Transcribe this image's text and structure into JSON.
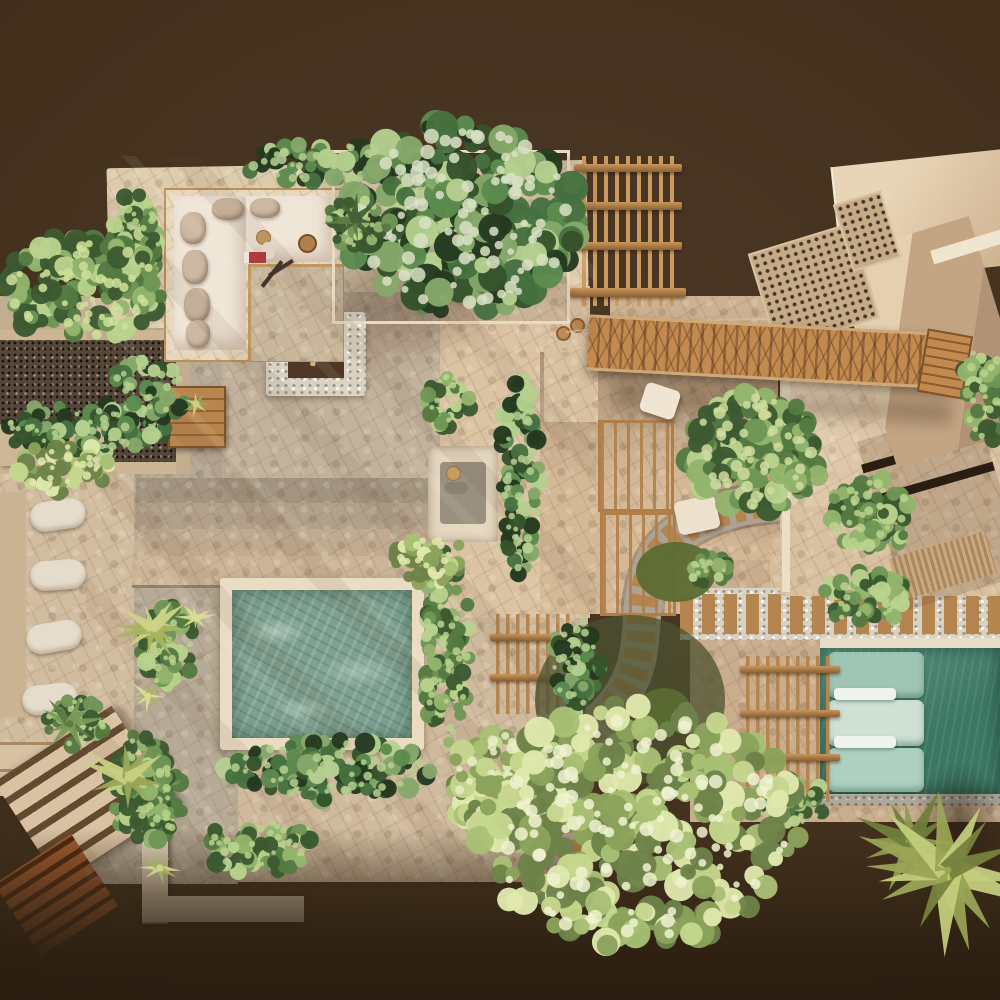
{
  "scene": {
    "description": "aerial-top-down-render-of-tropical-villa-rooftop-terraces",
    "visible_text": ""
  },
  "palette": {
    "background": "#43301d",
    "background_deep": "#2d2012",
    "terrace": "#d0ba9d",
    "terrace_light": "#ddcbae",
    "terrace_gray": "#b7aa96",
    "white_wall": "#e9dcc3",
    "sofa_cream": "#f0e6d8",
    "cushion_tan": "#cdb8a3",
    "wood": "#b5854f",
    "wood_dark": "#8a5f33",
    "wood_light": "#c9975c",
    "pool_main": "#7da090",
    "pool_main_highlight": "#cfe0d0",
    "pool_right": "#3c7763",
    "pool_right_light": "#5d9480",
    "daybed_mint": "#9fc5b4",
    "daybed_mint_light": "#cfe0d4",
    "gravel": "#55473a",
    "pebble": "#ddd6c8",
    "grass": "#5c6c33",
    "fire_logs": "#d9b07b",
    "person_hat": "#c79c63",
    "book_red": "#b23a3f"
  },
  "vegetation_palettes": {
    "greens_dark": [
      "#24391f",
      "#35522c",
      "#477041",
      "#5c8a4f",
      "#86a86a",
      "#b5cf8f"
    ],
    "greens_mid": [
      "#3c5a31",
      "#547a42",
      "#6f9655",
      "#93b46d",
      "#b9d28c"
    ],
    "greens_light": [
      "#6d8249",
      "#8ba25c",
      "#a9bf75",
      "#c6d68e",
      "#e0e8ad"
    ]
  },
  "grass": [
    {
      "name": "undergrowth",
      "cx": 630,
      "cy": 700,
      "rx": 95,
      "ry": 85,
      "color": "#4c5230",
      "opacity": 0.75
    },
    {
      "name": "grass-1",
      "cx": 676,
      "cy": 572,
      "rx": 40,
      "ry": 30,
      "color": "#5c6c33",
      "opacity": 0.95
    },
    {
      "name": "grass-2",
      "cx": 664,
      "cy": 708,
      "rx": 26,
      "ry": 20,
      "color": "#5c6c33",
      "opacity": 0.9
    }
  ],
  "foliage": [
    {
      "name": "planter-hedge-top",
      "cx": 332,
      "cy": 162,
      "rx": 92,
      "ry": 20,
      "n": 70,
      "rmin": 5,
      "rmax": 11,
      "pal": "greens_dark",
      "seed": 1
    },
    {
      "name": "big-tree-top",
      "cx": 462,
      "cy": 218,
      "rx": 118,
      "ry": 96,
      "n": 230,
      "rmin": 7,
      "rmax": 17,
      "pal": "greens_dark",
      "seed": 2,
      "hi": "#d9e0c4"
    },
    {
      "name": "terrace-left-hedge",
      "cx": 136,
      "cy": 248,
      "rx": 26,
      "ry": 58,
      "n": 55,
      "rmin": 5,
      "rmax": 10,
      "pal": "greens_mid",
      "seed": 3
    },
    {
      "name": "overhang-tree-left",
      "cx": 82,
      "cy": 288,
      "rx": 80,
      "ry": 52,
      "n": 115,
      "rmin": 6,
      "rmax": 13,
      "pal": "greens_mid",
      "seed": 4,
      "hi": "#cfe09a"
    },
    {
      "name": "gravel-hedge",
      "cx": 88,
      "cy": 428,
      "rx": 88,
      "ry": 26,
      "n": 85,
      "rmin": 5,
      "rmax": 10,
      "pal": "greens_dark",
      "seed": 5
    },
    {
      "name": "gravel-bush",
      "cx": 64,
      "cy": 468,
      "rx": 46,
      "ry": 26,
      "n": 45,
      "rmin": 5,
      "rmax": 10,
      "pal": "greens_light",
      "seed": 6
    },
    {
      "name": "gravel-bush-2",
      "cx": 150,
      "cy": 390,
      "rx": 40,
      "ry": 30,
      "n": 42,
      "rmin": 5,
      "rmax": 9,
      "pal": "greens_dark",
      "seed": 7
    },
    {
      "name": "sofa-palm",
      "cx": 356,
      "cy": 224,
      "rx": 36,
      "ry": 24,
      "n": 35,
      "rmin": 4,
      "rmax": 9,
      "pal": "greens_mid",
      "seed": 8
    },
    {
      "name": "palm-column",
      "cx": 520,
      "cy": 478,
      "rx": 20,
      "ry": 102,
      "n": 75,
      "rmin": 5,
      "rmax": 10,
      "pal": "greens_dark",
      "seed": 9
    },
    {
      "name": "bush-above-column",
      "cx": 448,
      "cy": 402,
      "rx": 22,
      "ry": 28,
      "n": 30,
      "rmin": 4,
      "rmax": 9,
      "pal": "greens_mid",
      "seed": 10
    },
    {
      "name": "pool-right-hedge",
      "cx": 446,
      "cy": 648,
      "rx": 24,
      "ry": 98,
      "n": 80,
      "rmin": 5,
      "rmax": 10,
      "pal": "greens_mid",
      "seed": 11
    },
    {
      "name": "pool-corner-bush",
      "cx": 430,
      "cy": 560,
      "rx": 36,
      "ry": 26,
      "n": 40,
      "rmin": 5,
      "rmax": 10,
      "pal": "greens_light",
      "seed": 12
    },
    {
      "name": "pool-bottom-hedge",
      "cx": 330,
      "cy": 770,
      "rx": 105,
      "ry": 30,
      "n": 100,
      "rmin": 5,
      "rmax": 11,
      "pal": "greens_dark",
      "seed": 13
    },
    {
      "name": "pool-left-shrub-1",
      "cx": 168,
      "cy": 648,
      "rx": 28,
      "ry": 42,
      "n": 45,
      "rmin": 5,
      "rmax": 10,
      "pal": "greens_mid",
      "seed": 14
    },
    {
      "name": "pool-left-shrub-2",
      "cx": 140,
      "cy": 786,
      "rx": 32,
      "ry": 52,
      "n": 55,
      "rmin": 5,
      "rmax": 10,
      "pal": "greens_mid",
      "seed": 15
    },
    {
      "name": "bush-below-pool",
      "cx": 258,
      "cy": 846,
      "rx": 54,
      "ry": 28,
      "n": 50,
      "rmin": 5,
      "rmax": 10,
      "pal": "greens_mid",
      "seed": 16
    },
    {
      "name": "path-hedge",
      "cx": 576,
      "cy": 662,
      "rx": 26,
      "ry": 52,
      "n": 48,
      "rmin": 5,
      "rmax": 10,
      "pal": "greens_dark",
      "seed": 17
    },
    {
      "name": "walkway-bush",
      "cx": 864,
      "cy": 598,
      "rx": 46,
      "ry": 26,
      "n": 45,
      "rmin": 5,
      "rmax": 10,
      "pal": "greens_mid",
      "seed": 18
    },
    {
      "name": "stairs-fern",
      "cx": 76,
      "cy": 722,
      "rx": 30,
      "ry": 24,
      "n": 34,
      "rmin": 4,
      "rmax": 9,
      "pal": "greens_mid",
      "seed": 19
    },
    {
      "name": "planter-corner-plants",
      "cx": 152,
      "cy": 800,
      "rx": 32,
      "ry": 42,
      "n": 48,
      "rmin": 5,
      "rmax": 10,
      "pal": "greens_mid",
      "seed": 20
    },
    {
      "name": "court-tree-right",
      "cx": 754,
      "cy": 452,
      "rx": 70,
      "ry": 60,
      "n": 135,
      "rmin": 6,
      "rmax": 14,
      "pal": "greens_mid",
      "seed": 21,
      "hi": "#cfdc9e"
    },
    {
      "name": "court-tree-small",
      "cx": 872,
      "cy": 514,
      "rx": 44,
      "ry": 38,
      "n": 60,
      "rmin": 5,
      "rmax": 11,
      "pal": "greens_mid",
      "seed": 22
    },
    {
      "name": "right-edge-shrub",
      "cx": 986,
      "cy": 392,
      "rx": 26,
      "ry": 50,
      "n": 40,
      "rmin": 5,
      "rmax": 10,
      "pal": "greens_mid",
      "seed": 23
    },
    {
      "name": "walkway-start-bush",
      "cx": 708,
      "cy": 568,
      "rx": 22,
      "ry": 16,
      "n": 20,
      "rmin": 4,
      "rmax": 8,
      "pal": "greens_mid",
      "seed": 24
    },
    {
      "name": "pergola-vine",
      "cx": 790,
      "cy": 802,
      "rx": 40,
      "ry": 24,
      "n": 38,
      "rmin": 5,
      "rmax": 9,
      "pal": "greens_mid",
      "seed": 25
    },
    {
      "name": "big-tree-bottom-left",
      "cx": 514,
      "cy": 788,
      "rx": 68,
      "ry": 58,
      "n": 105,
      "rmin": 6,
      "rmax": 13,
      "pal": "greens_light",
      "seed": 26,
      "hi": "#e8edc6"
    },
    {
      "name": "big-tree-bottom",
      "cx": 638,
      "cy": 826,
      "rx": 162,
      "ry": 122,
      "n": 270,
      "rmin": 7,
      "rmax": 16,
      "pal": "greens_light",
      "seed": 27,
      "hi": "#eef2cf"
    }
  ],
  "palms": [
    {
      "name": "palm-pool-left-1",
      "cx": 152,
      "cy": 628,
      "len": 42,
      "n": 11,
      "colors": [
        "#ccd386",
        "#a9b45f"
      ],
      "seed": 42
    },
    {
      "name": "palm-pool-left-2",
      "cx": 128,
      "cy": 778,
      "len": 48,
      "n": 11,
      "colors": [
        "#c8cf82",
        "#9aa757"
      ],
      "seed": 43
    },
    {
      "name": "palm-sofa",
      "cx": 354,
      "cy": 220,
      "len": 30,
      "n": 9,
      "colors": [
        "#446036",
        "#5d7c46"
      ],
      "seed": 44
    },
    {
      "name": "fern-stairs",
      "cx": 70,
      "cy": 724,
      "len": 34,
      "n": 9,
      "colors": [
        "#5d7a43",
        "#7a9a58"
      ],
      "seed": 45
    },
    {
      "name": "agave-pool",
      "cx": 196,
      "cy": 618,
      "len": 20,
      "n": 8,
      "colors": [
        "#d8dc92",
        "#b9c274"
      ],
      "seed": 46
    },
    {
      "name": "agave-left",
      "cx": 148,
      "cy": 696,
      "len": 22,
      "n": 8,
      "colors": [
        "#d8dc92",
        "#aab364"
      ],
      "seed": 47
    },
    {
      "name": "agave-planter",
      "cx": 160,
      "cy": 868,
      "len": 24,
      "n": 8,
      "colors": [
        "#cfd489",
        "#a3ae62"
      ],
      "seed": 48
    },
    {
      "name": "agave-box",
      "cx": 196,
      "cy": 404,
      "len": 16,
      "n": 7,
      "colors": [
        "#c9d184",
        "#99a45c"
      ],
      "seed": 49
    },
    {
      "name": "palm-bottom-right-2",
      "cx": 912,
      "cy": 842,
      "len": 58,
      "n": 12,
      "colors": [
        "#8f9c4f",
        "#6f7f3a"
      ],
      "seed": 50
    },
    {
      "name": "palm-bottom-right",
      "cx": 948,
      "cy": 870,
      "len": 95,
      "n": 15,
      "colors": [
        "#9aa455",
        "#c3cc7c",
        "#77823d"
      ],
      "seed": 41
    }
  ]
}
